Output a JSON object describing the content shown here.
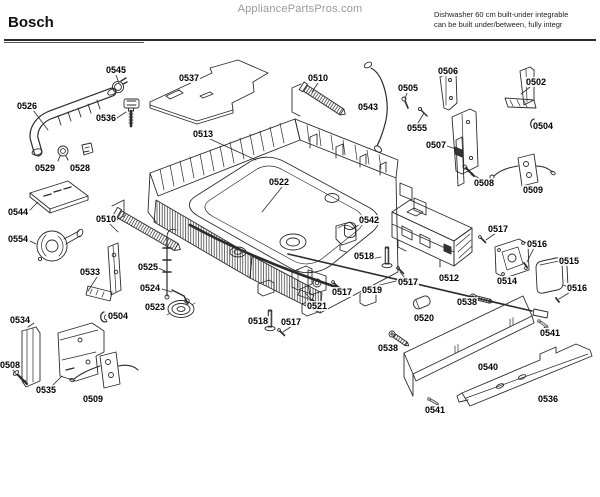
{
  "header": {
    "watermark": "AppliancePartsPros.com",
    "brand": "Bosch",
    "model_info_line1": "Dishwasher 60 cm built-under integrable",
    "model_info_line2": "can be built under/between, fully integr"
  },
  "diagram": {
    "type": "exploded-parts-diagram",
    "callouts": [
      {
        "label": "0545",
        "x": 116,
        "y": 70
      },
      {
        "label": "0537",
        "x": 189,
        "y": 78
      },
      {
        "label": "0510",
        "x": 318,
        "y": 78
      },
      {
        "label": "0506",
        "x": 448,
        "y": 71
      },
      {
        "label": "0502",
        "x": 536,
        "y": 82
      },
      {
        "label": "0505",
        "x": 408,
        "y": 88
      },
      {
        "label": "0526",
        "x": 27,
        "y": 106
      },
      {
        "label": "0543",
        "x": 368,
        "y": 107
      },
      {
        "label": "0536",
        "x": 106,
        "y": 118
      },
      {
        "label": "0504",
        "x": 543,
        "y": 126
      },
      {
        "label": "0555",
        "x": 417,
        "y": 128
      },
      {
        "label": "0513",
        "x": 203,
        "y": 134
      },
      {
        "label": "0507",
        "x": 436,
        "y": 145
      },
      {
        "label": "0529",
        "x": 45,
        "y": 168
      },
      {
        "label": "0528",
        "x": 80,
        "y": 168
      },
      {
        "label": "0522",
        "x": 279,
        "y": 182
      },
      {
        "label": "0508",
        "x": 484,
        "y": 183
      },
      {
        "label": "0509",
        "x": 533,
        "y": 190
      },
      {
        "label": "0544",
        "x": 18,
        "y": 212
      },
      {
        "label": "0510",
        "x": 106,
        "y": 219
      },
      {
        "label": "0542",
        "x": 369,
        "y": 220
      },
      {
        "label": "0517",
        "x": 498,
        "y": 229
      },
      {
        "label": "0554",
        "x": 18,
        "y": 239
      },
      {
        "label": "0516",
        "x": 537,
        "y": 244
      },
      {
        "label": "0518",
        "x": 364,
        "y": 256
      },
      {
        "label": "0515",
        "x": 569,
        "y": 261
      },
      {
        "label": "0525",
        "x": 148,
        "y": 267
      },
      {
        "label": "0533",
        "x": 90,
        "y": 272
      },
      {
        "label": "0512",
        "x": 449,
        "y": 278
      },
      {
        "label": "0514",
        "x": 507,
        "y": 281
      },
      {
        "label": "0517",
        "x": 408,
        "y": 282
      },
      {
        "label": "0524",
        "x": 150,
        "y": 288
      },
      {
        "label": "0516",
        "x": 577,
        "y": 288
      },
      {
        "label": "0519",
        "x": 372,
        "y": 290
      },
      {
        "label": "0517",
        "x": 342,
        "y": 292
      },
      {
        "label": "0538",
        "x": 467,
        "y": 302
      },
      {
        "label": "0521",
        "x": 317,
        "y": 306
      },
      {
        "label": "0523",
        "x": 155,
        "y": 307
      },
      {
        "label": "0504",
        "x": 118,
        "y": 316
      },
      {
        "label": "0520",
        "x": 424,
        "y": 318
      },
      {
        "label": "0534",
        "x": 20,
        "y": 320
      },
      {
        "label": "0518",
        "x": 258,
        "y": 321
      },
      {
        "label": "0517",
        "x": 291,
        "y": 322
      },
      {
        "label": "0541",
        "x": 550,
        "y": 333
      },
      {
        "label": "0538",
        "x": 388,
        "y": 348
      },
      {
        "label": "0508",
        "x": 10,
        "y": 365
      },
      {
        "label": "0540",
        "x": 488,
        "y": 367
      },
      {
        "label": "0535",
        "x": 46,
        "y": 390
      },
      {
        "label": "0536",
        "x": 548,
        "y": 399
      },
      {
        "label": "0509",
        "x": 93,
        "y": 399
      },
      {
        "label": "0541",
        "x": 435,
        "y": 410
      }
    ]
  },
  "colors": {
    "line": "#2b2b2b",
    "label": "#000000",
    "watermark": "#9a9a9a"
  }
}
